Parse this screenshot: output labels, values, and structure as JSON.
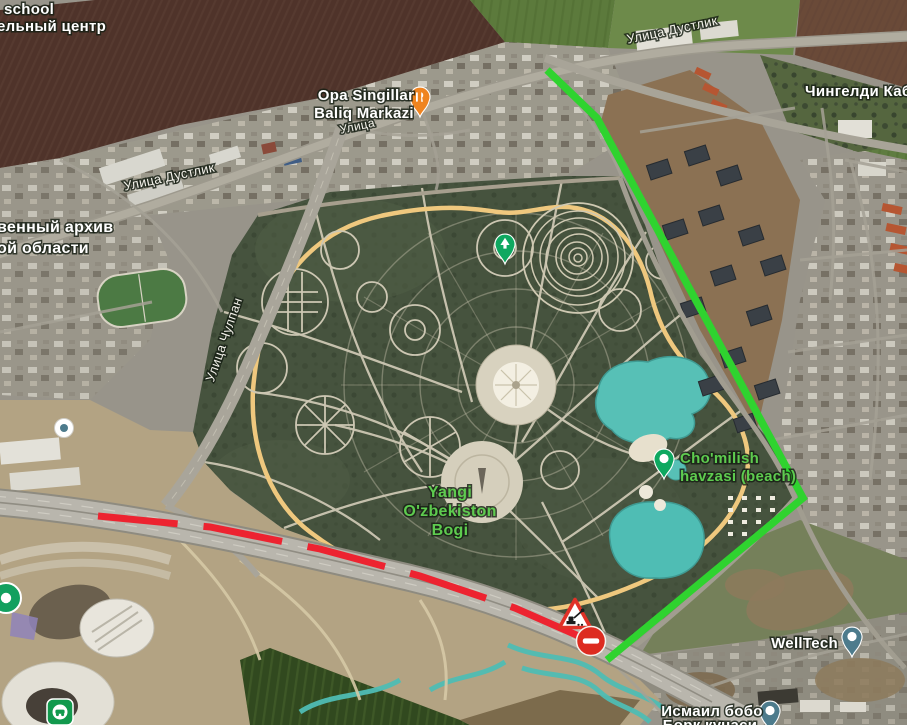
{
  "map": {
    "kind": "satellite-map",
    "colors": {
      "label_white": "#ffffff",
      "label_green": "#5ecb4f",
      "route_green": "#2fd32f",
      "route_red": "#ed2330",
      "pin_green": "#0ea860",
      "pin_orange": "#ef8420",
      "pin_slate": "#4d7b8c"
    },
    "labels": [
      {
        "id": "school",
        "text": "school",
        "x": 4,
        "y": 14,
        "size": 15,
        "color": "#ffffff",
        "anchor": "start",
        "interactable": true
      },
      {
        "id": "training-center",
        "text": "ельный центр",
        "x": -3,
        "y": 31,
        "size": 15,
        "color": "#ffffff",
        "anchor": "start",
        "interactable": true
      },
      {
        "id": "opa-singillar-line1",
        "text": "Opa Singillar",
        "x": 366,
        "y": 100,
        "size": 15,
        "color": "#ffffff",
        "interactable": true
      },
      {
        "id": "opa-singillar-line2",
        "text": "Baliq Markazi",
        "x": 364,
        "y": 118,
        "size": 15,
        "color": "#ffffff",
        "interactable": true
      },
      {
        "id": "street-dustlik-ne",
        "text": "Улица Дустлик",
        "x": 673,
        "y": 34,
        "size": 13,
        "color": "#f3f1ea",
        "rot": -12,
        "bold": false
      },
      {
        "id": "chingeldi-kabri",
        "text": "Чингелди Кабри",
        "x": 805,
        "y": 96,
        "size": 15,
        "color": "#ffffff",
        "anchor": "start",
        "interactable": true
      },
      {
        "id": "street-dustlik-w",
        "text": "Улица Дустлик",
        "x": 170,
        "y": 181,
        "size": 13,
        "color": "#f3f1ea",
        "rot": -12,
        "bold": false
      },
      {
        "id": "archive-line1",
        "text": "венный архив",
        "x": -3,
        "y": 232,
        "size": 16,
        "color": "#ffffff",
        "anchor": "start",
        "interactable": true
      },
      {
        "id": "archive-line2",
        "text": "ой области",
        "x": -3,
        "y": 253,
        "size": 16,
        "color": "#ffffff",
        "anchor": "start",
        "interactable": true
      },
      {
        "id": "street-chulpan",
        "text": "Улица Чулпан",
        "x": 228,
        "y": 341,
        "size": 13,
        "color": "#f3f1ea",
        "rot": -71,
        "bold": false
      },
      {
        "id": "street-partial",
        "text": "Улица",
        "x": 358,
        "y": 130,
        "size": 12,
        "color": "#f3f1ea",
        "rot": -12,
        "bold": false
      },
      {
        "id": "yangi-park-line1",
        "text": "Yangi",
        "x": 450,
        "y": 497,
        "size": 16,
        "color": "#5ecb4f",
        "interactable": true
      },
      {
        "id": "yangi-park-line2",
        "text": "O'zbekiston",
        "x": 450,
        "y": 516,
        "size": 16,
        "color": "#5ecb4f",
        "interactable": true
      },
      {
        "id": "yangi-park-line3",
        "text": "Bogi",
        "x": 450,
        "y": 535,
        "size": 16,
        "color": "#5ecb4f",
        "interactable": true
      },
      {
        "id": "beach-line1",
        "text": "Cho'milish",
        "x": 680,
        "y": 463,
        "size": 15,
        "color": "#5ecb4f",
        "anchor": "start",
        "interactable": true
      },
      {
        "id": "beach-line2",
        "text": "havzasi (beach)",
        "x": 680,
        "y": 481,
        "size": 15,
        "color": "#5ecb4f",
        "anchor": "start",
        "interactable": true
      },
      {
        "id": "welltech",
        "text": "WellTech",
        "x": 838,
        "y": 648,
        "size": 15,
        "color": "#ffffff",
        "anchor": "end",
        "interactable": true
      },
      {
        "id": "ismail-bobo-line1",
        "text": "Исмаил бобо",
        "x": 712,
        "y": 716,
        "size": 15,
        "color": "#ffffff",
        "interactable": true
      },
      {
        "id": "ismail-bobo-line2",
        "text": "Борк кучаси",
        "x": 710,
        "y": 730,
        "size": 15,
        "color": "#ffffff",
        "interactable": true
      }
    ],
    "routes": [
      {
        "id": "route-green",
        "color": "#2fd32f",
        "width": 7.5,
        "points": [
          [
            547,
            70
          ],
          [
            597,
            118
          ],
          [
            803,
            498
          ],
          [
            607,
            660
          ]
        ]
      },
      {
        "id": "route-red-dashed",
        "color": "#ed2330",
        "width": 7,
        "dash": "80 26",
        "points": [
          [
            98,
            516
          ],
          [
            210,
            527
          ],
          [
            320,
            549
          ],
          [
            420,
            576
          ],
          [
            515,
            608
          ],
          [
            606,
            648
          ]
        ]
      }
    ],
    "pins": [
      {
        "id": "restaurant-pin",
        "kind": "teardrop",
        "glyph": "restaurant",
        "color": "#ef8420",
        "x": 420,
        "y": 97,
        "interactable": true
      },
      {
        "id": "park-pin",
        "kind": "teardrop",
        "glyph": "tree",
        "color": "#0ea860",
        "x": 505,
        "y": 244,
        "interactable": true
      },
      {
        "id": "beach-pin",
        "kind": "teardrop",
        "glyph": "dot",
        "color": "#0ea860",
        "x": 664,
        "y": 459,
        "interactable": true
      },
      {
        "id": "welltech-pin",
        "kind": "teardrop",
        "glyph": "dot",
        "color": "#4d7b8c",
        "x": 852,
        "y": 637,
        "interactable": true
      },
      {
        "id": "ismail-pin",
        "kind": "teardrop",
        "glyph": "dot",
        "color": "#4d7b8c",
        "x": 770,
        "y": 711,
        "interactable": true
      },
      {
        "id": "left-green-pin",
        "kind": "circle",
        "color": "#12a05f",
        "x": 6,
        "y": 598,
        "interactable": true
      },
      {
        "id": "school-poi-pin",
        "kind": "circle-white",
        "color": "#4d7b8c",
        "x": 64,
        "y": 428,
        "interactable": true
      },
      {
        "id": "car-service-icon",
        "kind": "square",
        "glyph": "car",
        "color": "#12994d",
        "x": 60,
        "y": 712,
        "interactable": true
      }
    ],
    "signs": [
      {
        "id": "roadwork-sign",
        "type": "roadwork",
        "x": 575,
        "y": 616
      },
      {
        "id": "no-entry-sign",
        "type": "no-entry",
        "x": 591,
        "y": 641
      }
    ]
  }
}
